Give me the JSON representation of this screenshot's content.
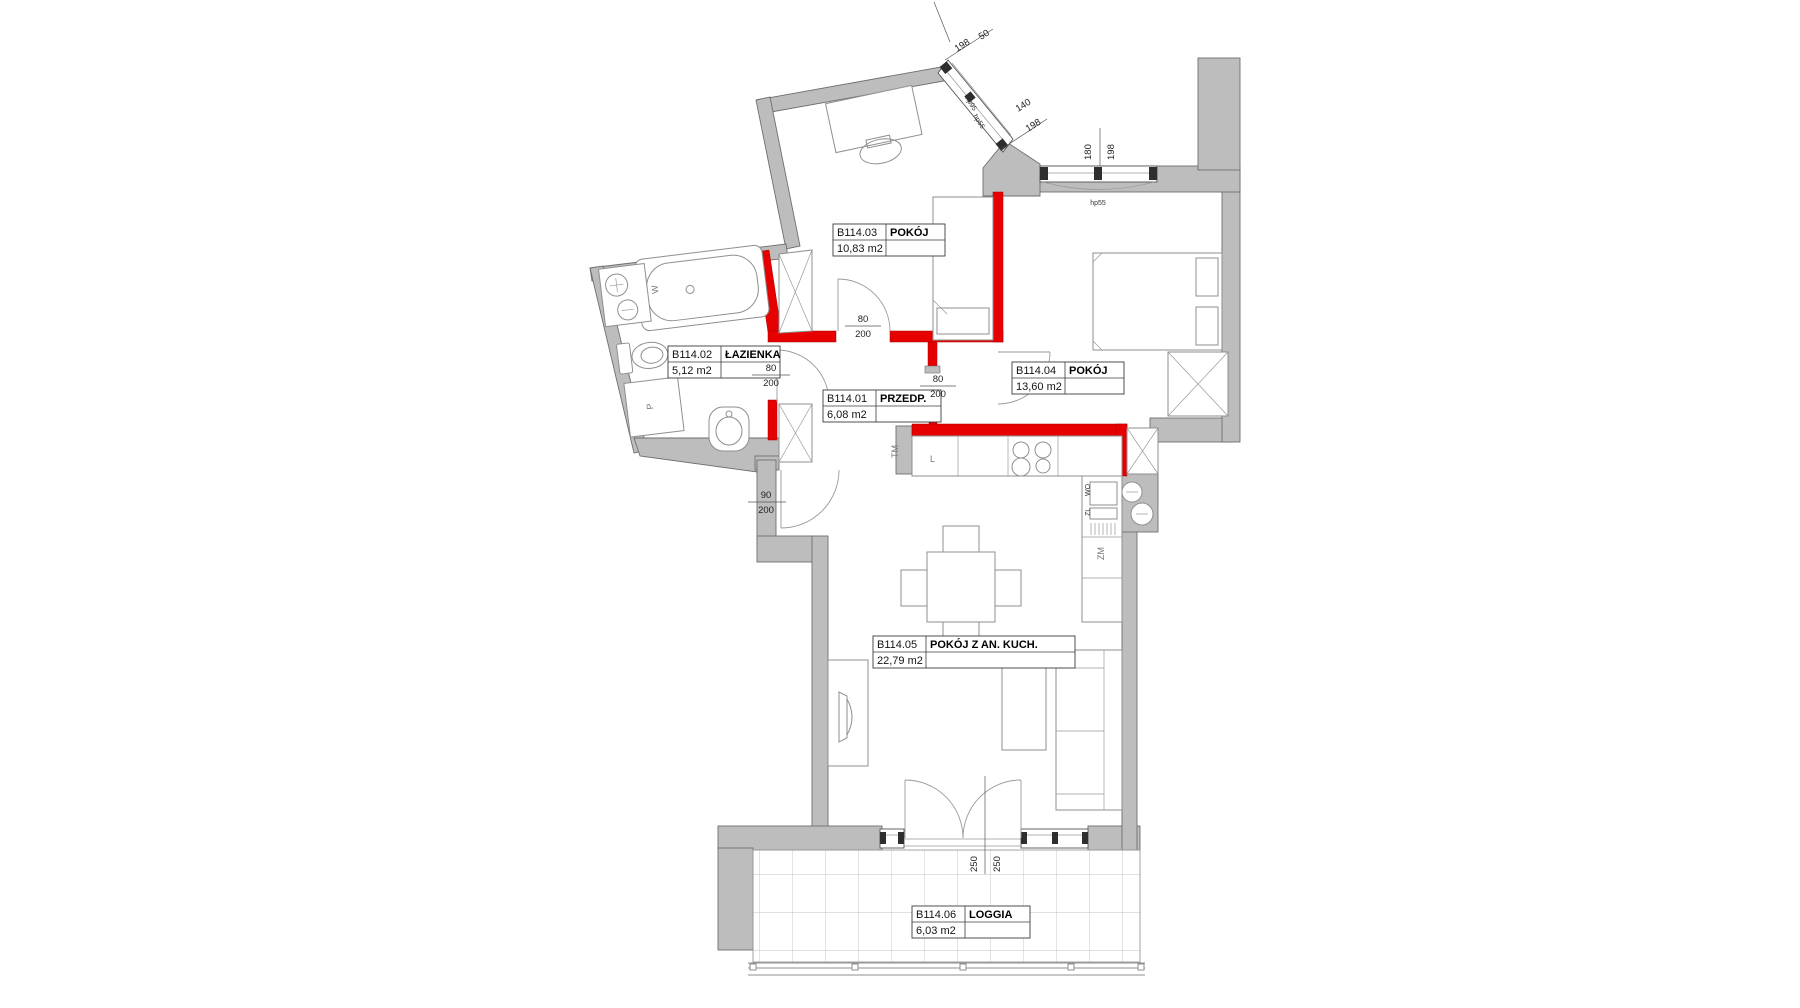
{
  "plan": {
    "rooms": [
      {
        "code": "B114.01",
        "name": "PRZEDP.",
        "area": "6,08 m2"
      },
      {
        "code": "B114.02",
        "name": "ŁAZIENKA",
        "area": "5,12 m2"
      },
      {
        "code": "B114.03",
        "name": "POKÓJ",
        "area": "10,83 m2"
      },
      {
        "code": "B114.04",
        "name": "POKÓJ",
        "area": "13,60 m2"
      },
      {
        "code": "B114.05",
        "name": "POKÓJ Z AN. KUCH.",
        "area": "22,79 m2"
      },
      {
        "code": "B114.06",
        "name": "LOGGIA",
        "area": "6,03 m2"
      }
    ],
    "dims": {
      "door_w": "80",
      "door_h": "200",
      "entry_w": "90",
      "entry_h": "200",
      "balcony_leaf": "250",
      "win_right_w": "180",
      "win_right_o": "198",
      "win_right_sill": "hp55",
      "win_top_seg1": "50",
      "win_top_seg1_sill": "hp95",
      "win_top_seg2": "140",
      "win_top_o": "198",
      "win_top_sill": "hp55"
    },
    "fixtures": {
      "bathtub": "W",
      "washing_machine": "P",
      "fridge": "L",
      "meter_panel": "TM",
      "dishwasher": "ZM",
      "sink_label_top": "WO",
      "sink_label_bottom": "ZL"
    },
    "colors": {
      "wall": "#bdbdbd",
      "wall_edge": "#6e6e6e",
      "red_wall": "#e60000",
      "line": "#8f8f8f",
      "text": "#141414"
    }
  }
}
